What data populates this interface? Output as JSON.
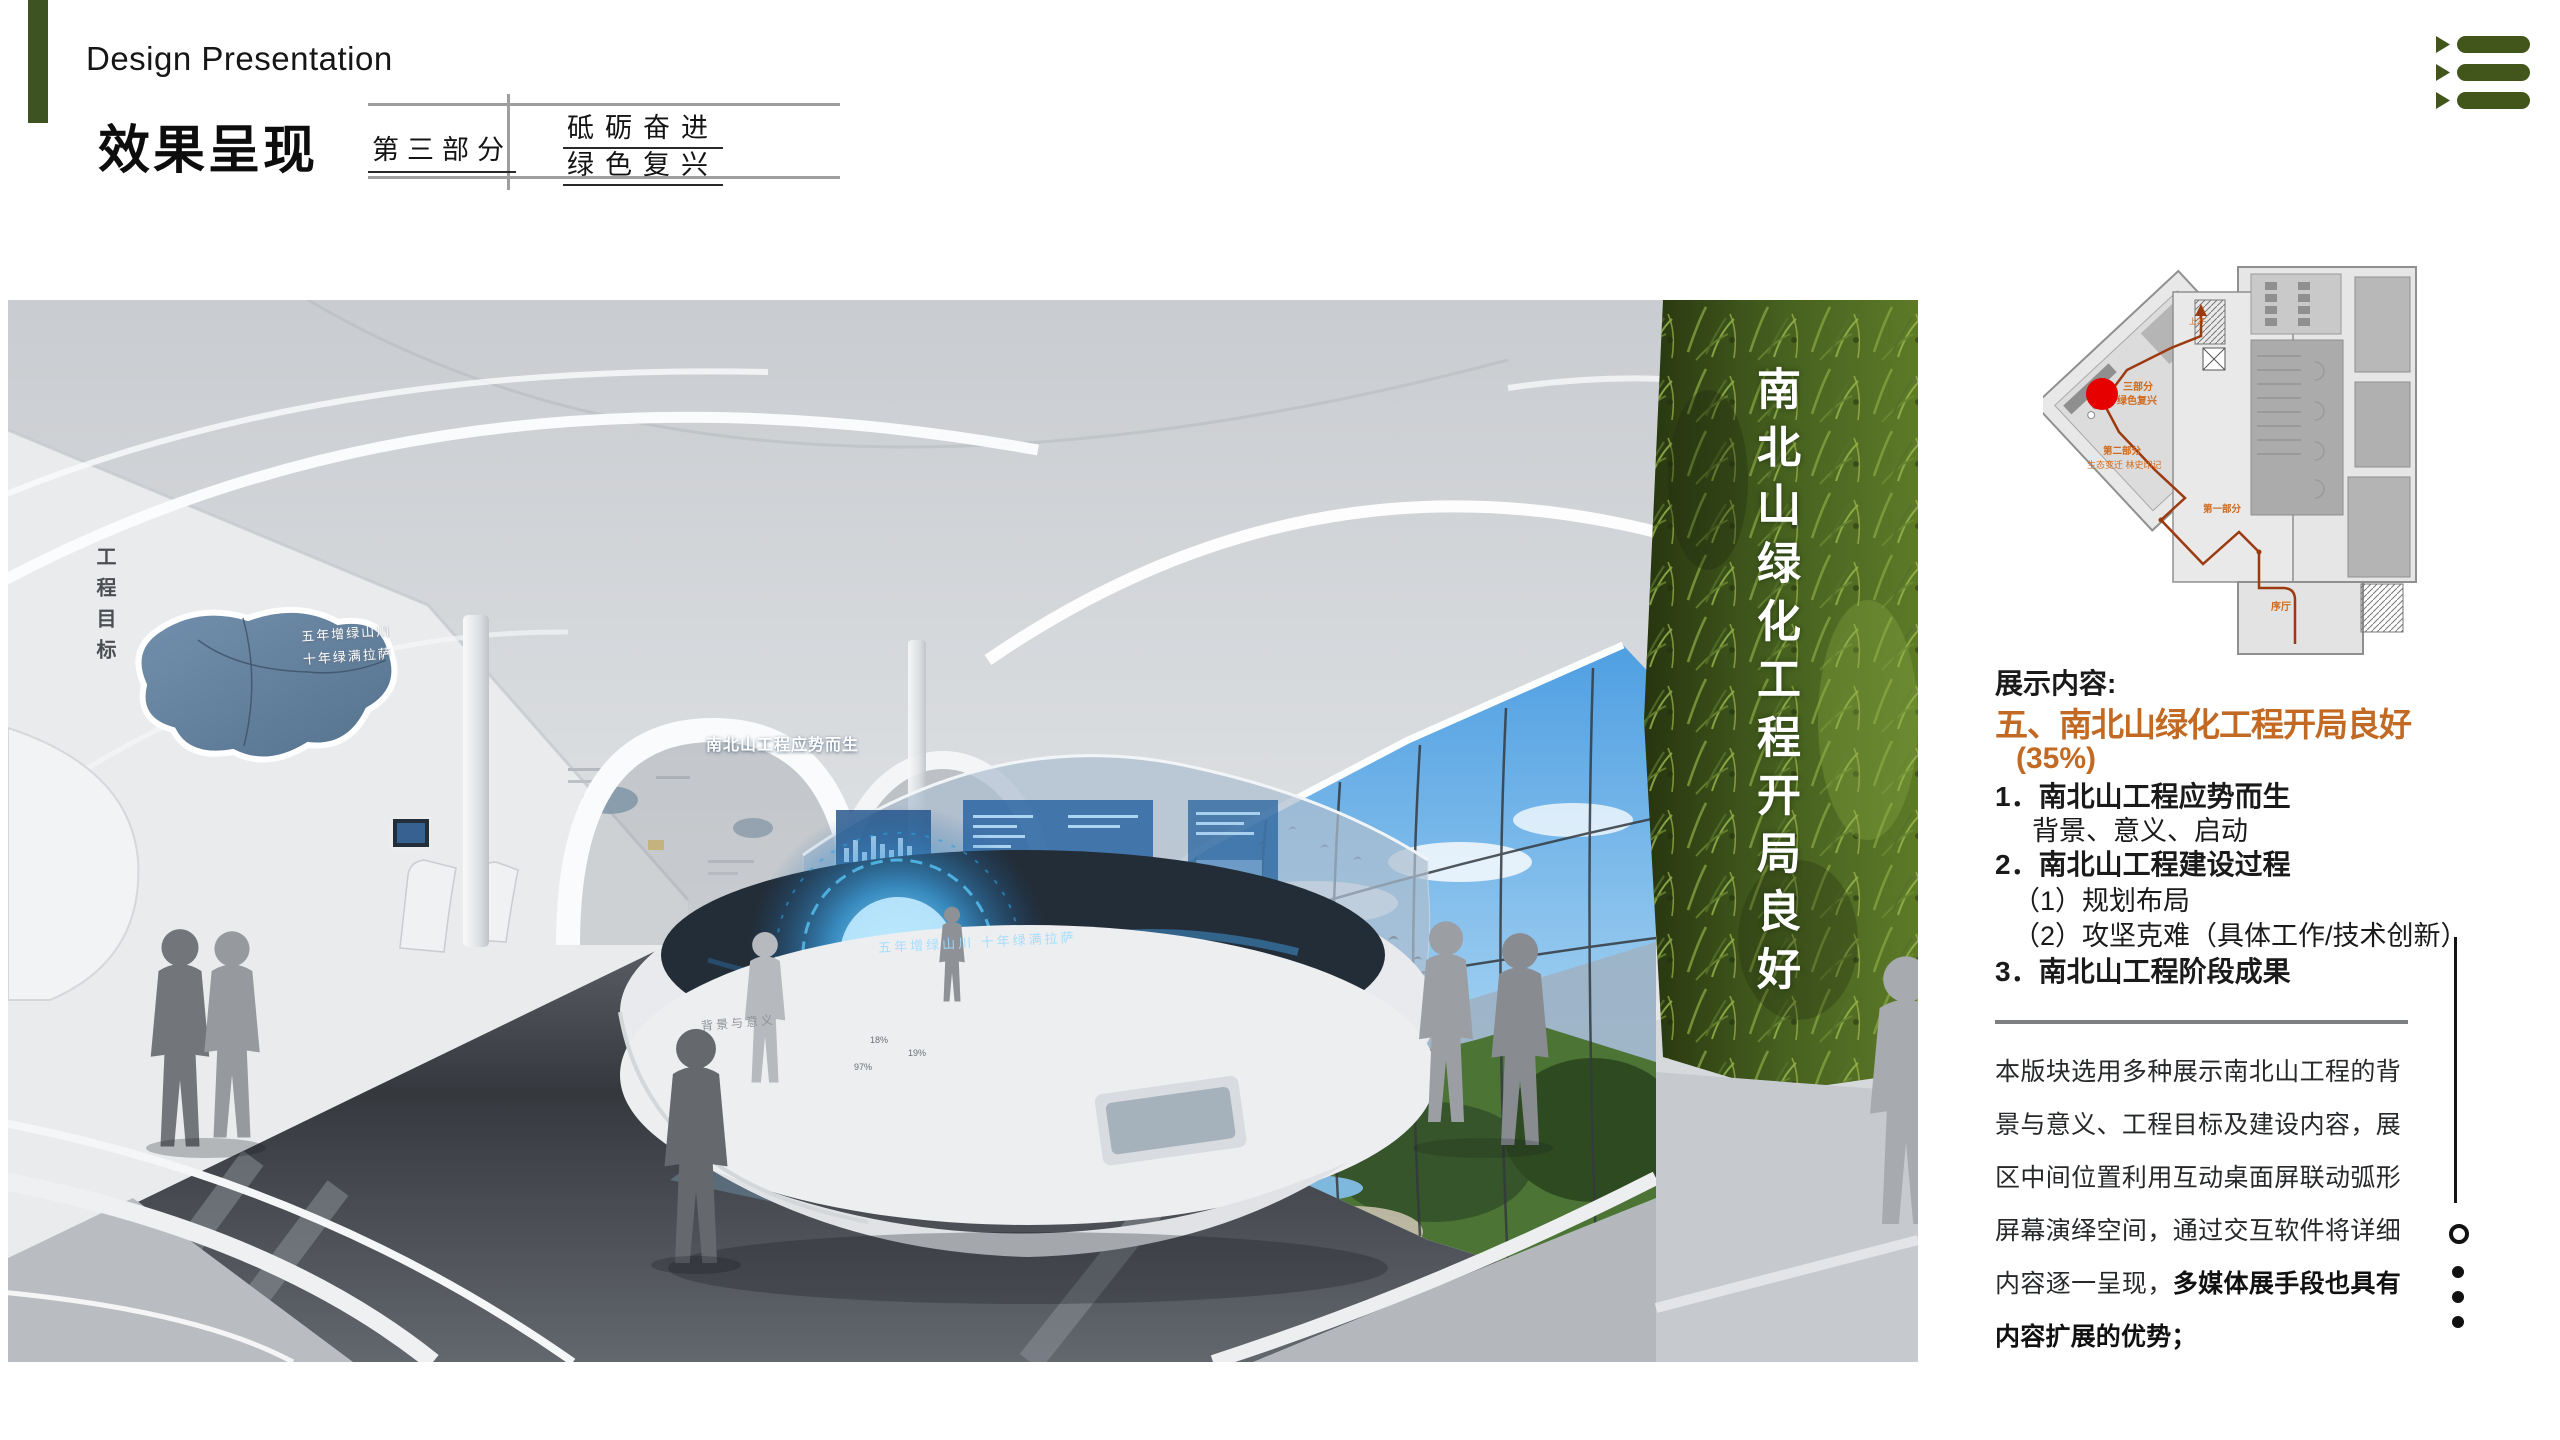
{
  "slide": {
    "title_en": "Design Presentation",
    "title_cn": "效果呈现",
    "part_label": "第三部分",
    "part_slogan_line1": "砥砺奋进",
    "part_slogan_line2": "绿色复兴"
  },
  "colors": {
    "accent_green": "#3e5322",
    "accent_orange": "#c26a23",
    "marker_red": "#e60000",
    "route_red": "#9c3a10"
  },
  "render": {
    "left_wall_vertical_text": "工程目标",
    "wall_slogan_line1": "五年增绿山川",
    "wall_slogan_line2": "十年绿满拉萨",
    "screen_title": "南北山工程应势而生",
    "table_surface_text": "五年增绿山川 十年绿满拉萨",
    "table_front_label": "背景与意义",
    "table_marks": [
      "18%",
      "19%",
      "97%"
    ],
    "green_wall_vertical_text": "南北山绿化工程开局良好"
  },
  "floor_plan": {
    "part3_label_line1": "三部分",
    "part3_label_line2": "绿色复兴",
    "part2_label_line1": "第二部分",
    "part2_label_line2": "生态变迁 林史印记",
    "part1_label": "第一部分",
    "hall_label": "序厅",
    "stairs_label": "上2F"
  },
  "content": {
    "heading": "展示内容:",
    "title": "五、南北山绿化工程开局良好",
    "percent": "(35%)",
    "items": [
      "1．南北山工程应势而生",
      "背景、意义、启动",
      "2．南北山工程建设过程",
      "（1）规划布局",
      "（2）攻坚克难（具体工作/技术创新）",
      "3．南北山工程阶段成果"
    ],
    "paragraph_normal": "本版块选用多种展示南北山工程的背景与意义、工程目标及建设内容，展区中间位置利用互动桌面屏联动弧形屏幕演绎空间，通过交互软件将详细内容逐一呈现，",
    "paragraph_bold": "多媒体展手段也具有内容扩展的优势；"
  }
}
